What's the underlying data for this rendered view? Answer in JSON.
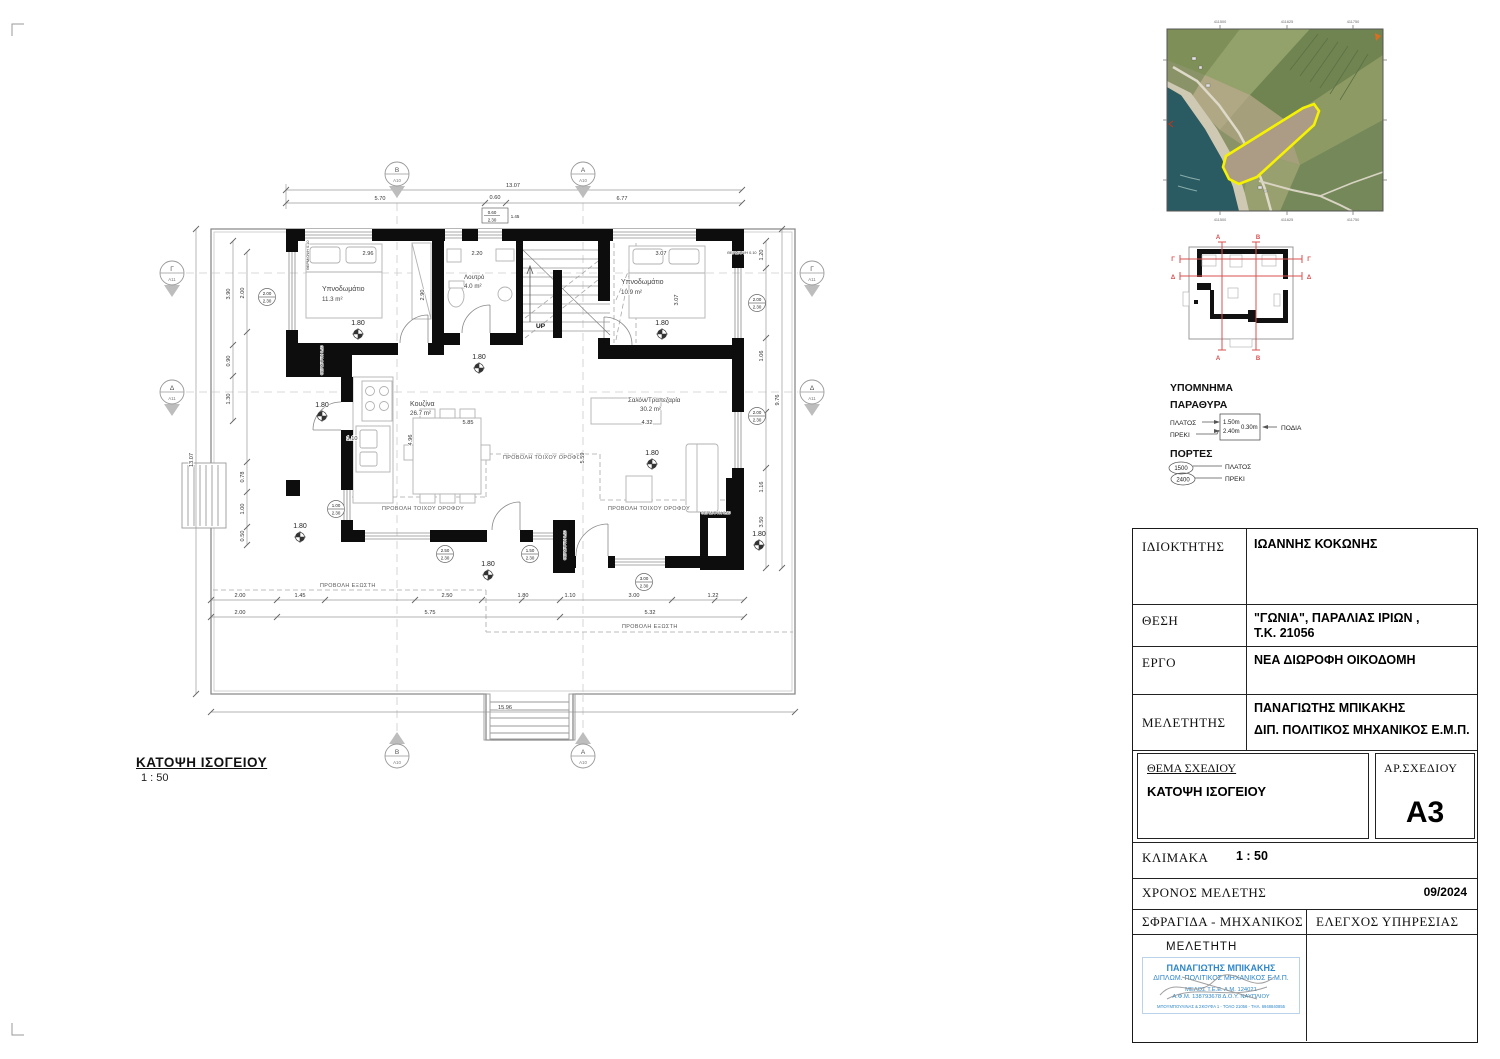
{
  "sheet": {
    "title": "ΚΑΤΟΨΗ ΙΣΟΓΕΙΟΥ",
    "scale": "1 : 50"
  },
  "plan": {
    "rooms": [
      {
        "name": "Υπνοδωμάτιο",
        "area": "11.3 m²"
      },
      {
        "name": "Λουτρό",
        "area": "4.0 m²"
      },
      {
        "name": "Υπνοδωμάτιο",
        "area": "10.9 m²"
      },
      {
        "name": "Κουζίνα",
        "area": "26.7 m²"
      },
      {
        "name": "Σαλόνι/Τραπεζαρία",
        "area": "30.2 m²"
      }
    ],
    "level": "1.80",
    "up": "UP",
    "wall_projection": "ΠΡΟΒΟΛΗ ΤΟΙΧΟΥ ΟΡΟΦΟΥ",
    "balcony_projection": "ΠΡΟΒΟΛΗ ΕΞΩΣΤΗ",
    "insulation": "ΘΕΡΜ/ΟΨΗ 0.10",
    "markers": {
      "a": "Α",
      "b": "Β",
      "g": "Γ",
      "d": "Δ",
      "sheet_a": "Α10",
      "sheet_s": "Α11"
    },
    "dims": {
      "overall_top": "13.07",
      "top": [
        "5.70",
        "0.60",
        "6.77"
      ],
      "top_tag": {
        "w": "0.60",
        "h": "2.30",
        "sill": "1.45"
      },
      "bottom1": [
        "2.00",
        "1.45",
        "2.50",
        "1.80",
        "1.10",
        "3.00",
        "1.22"
      ],
      "bottom2": [
        "2.00",
        "5.75",
        "5.32"
      ],
      "overall_bottom": "15.96",
      "left1": [
        "3.90",
        "0.90",
        "1.30"
      ],
      "left2": [
        "2.00",
        "0.78",
        "1.00",
        "0.50"
      ],
      "left_outer": "13.07",
      "right1": [
        "1.20",
        "1.06",
        "1.16",
        "3.50"
      ],
      "right_outer": "9.76",
      "interior": [
        "2.96",
        "2.90",
        "2.20",
        "3.07",
        "3.07",
        "5.85",
        "4.96",
        "5.59",
        "4.32",
        "1.10"
      ]
    },
    "window_tags": [
      {
        "w": "2.00",
        "h": "2.30"
      },
      {
        "w": "2.00",
        "h": "2.30"
      },
      {
        "w": "2.00",
        "h": "2.30"
      },
      {
        "w": "1.00",
        "h": "2.30"
      },
      {
        "w": "2.50",
        "h": "2.30"
      },
      {
        "w": "1.50",
        "h": "2.30"
      },
      {
        "w": "3.00",
        "h": "2.30"
      }
    ]
  },
  "legend": {
    "heading": "ΥΠΟΜΝΗΜΑ",
    "windows_heading": "ΠΑΡΑΘΥΡΑ",
    "width_label": "ΠΛΑΤΟΣ",
    "lintel_label": "ΠΡΕΚΙ",
    "sill_label": "ΠΟΔΙΑ",
    "win_width": "1.50m",
    "win_lintel": "2.40m",
    "win_sill": "0.30m",
    "doors_heading": "ΠΟΡΤΕΣ",
    "door_width": "1500",
    "door_lintel": "2400"
  },
  "site_map": {
    "ticks": [
      "411500",
      "411625",
      "411750"
    ]
  },
  "title_block": {
    "owner_label": "ΙΔΙΟΚΤΗΤΗΣ",
    "owner": "ΙΩΑΝΝΗΣ ΚΟΚΩΝΗΣ",
    "location_label": "ΘΕΣΗ",
    "location1": "\"ΓΩΝΙΑ\", ΠΑΡΑΛΙΑΣ ΙΡΙΩΝ ,",
    "location2": "Τ.Κ. 21056",
    "project_label": "ΕΡΓΟ",
    "project": "ΝΕΑ ΔΙΩΡΟΦΗ ΟΙΚΟΔΟΜΗ",
    "engineer_label": "ΜΕΛΕΤΗΤΗΣ",
    "engineer1": "ΠΑΝΑΓΙΩΤΗΣ ΜΠΙΚΑΚΗΣ",
    "engineer2": "ΔΙΠ. ΠΟΛΙΤΙΚΟΣ ΜΗΧΑΝΙΚΟΣ Ε.Μ.Π.",
    "subject_label": "ΘΕΜΑ ΣΧΕΔΙΟΥ",
    "subject": "ΚΑΤΟΨΗ ΙΣΟΓΕΙΟΥ",
    "number_label": "ΑΡ.ΣΧΕΔΙΟΥ",
    "number": "A3",
    "scale_label": "ΚΛΙΜΑΚΑ",
    "scale": "1 : 50",
    "date_label": "ΧΡΟΝΟΣ ΜΕΛΕΤΗΣ",
    "date": "09/2024",
    "stamp_label": "ΣΦΡΑΓΙΔΑ - ΜΗΧΑΝΙΚΟΣ",
    "check_label": "ΕΛΕΓΧΟΣ ΥΠΗΡΕΣΙΑΣ"
  },
  "stamp": {
    "heading": "ΜΕΛΕΤΗΤΗ",
    "line1": "ΠΑΝΑΓΙΩΤΗΣ ΜΠΙΚΑΚΗΣ",
    "line2": "ΔΙΠΛΩΜ. ΠΟΛΙΤΙΚΟΣ ΜΗΧΑΝΙΚΟΣ Ε.Μ.Π.",
    "line3": "ΜΕΛΟΣ Τ.Ε.Ε.  Α.Μ. 124021",
    "line4": "Α.Φ.Μ. 138793678  Δ.Ο.Υ. ΝΑΥΠΛΙΟΥ",
    "line5": "ΜΠΟΥΜΠΟΥΛΙΝΑΣ & ΣΚΟΥΦΑ 1 - ΤΟΛΟ 21056 - ΤΗΛ. 6948840855"
  }
}
